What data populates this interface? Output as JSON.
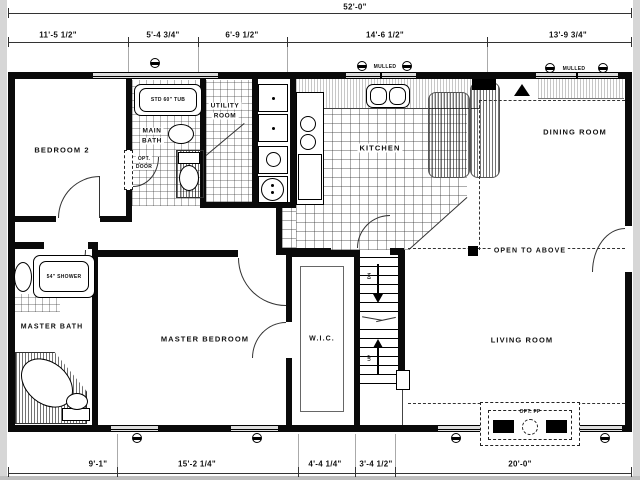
{
  "plan": {
    "overall_width_label": "52'-0\"",
    "dims_top": [
      "11'-5 1/2\"",
      "5'-4 3/4\"",
      "6'-9 1/2\"",
      "14'-6 1/2\"",
      "13'-9 3/4\""
    ],
    "dims_bottom": [
      "9'-1\"",
      "15'-2 1/4\"",
      "4'-4 1/4\"",
      "3'-4 1/2\"",
      "20'-0\""
    ],
    "rooms": {
      "bedroom2": "BEDROOM 2",
      "main_bath_line1": "MAIN",
      "main_bath_line2": "BATH",
      "utility_line1": "UTILITY",
      "utility_line2": "ROOM",
      "kitchen": "KITCHEN",
      "dining": "DINING ROOM",
      "master_bath": "MASTER BATH",
      "master_bedroom": "MASTER BEDROOM",
      "wic": "W.I.C.",
      "living": "LIVING ROOM",
      "open_to_above": "OPEN TO ABOVE"
    },
    "annotations": {
      "tub": "STD 60\" TUB",
      "shower": "54\" SHOWER",
      "opt_door_line1": "OPT.",
      "opt_door_line2": "DOOR",
      "opt_fireplace": "OPT. FP",
      "mulled": "MULLED",
      "stair_up": "UP",
      "stair_down": "DN"
    },
    "colors": {
      "wall": "#0a0a0a",
      "window_fill": "#dddddd",
      "edge_gray": "#d6d6d6"
    }
  }
}
